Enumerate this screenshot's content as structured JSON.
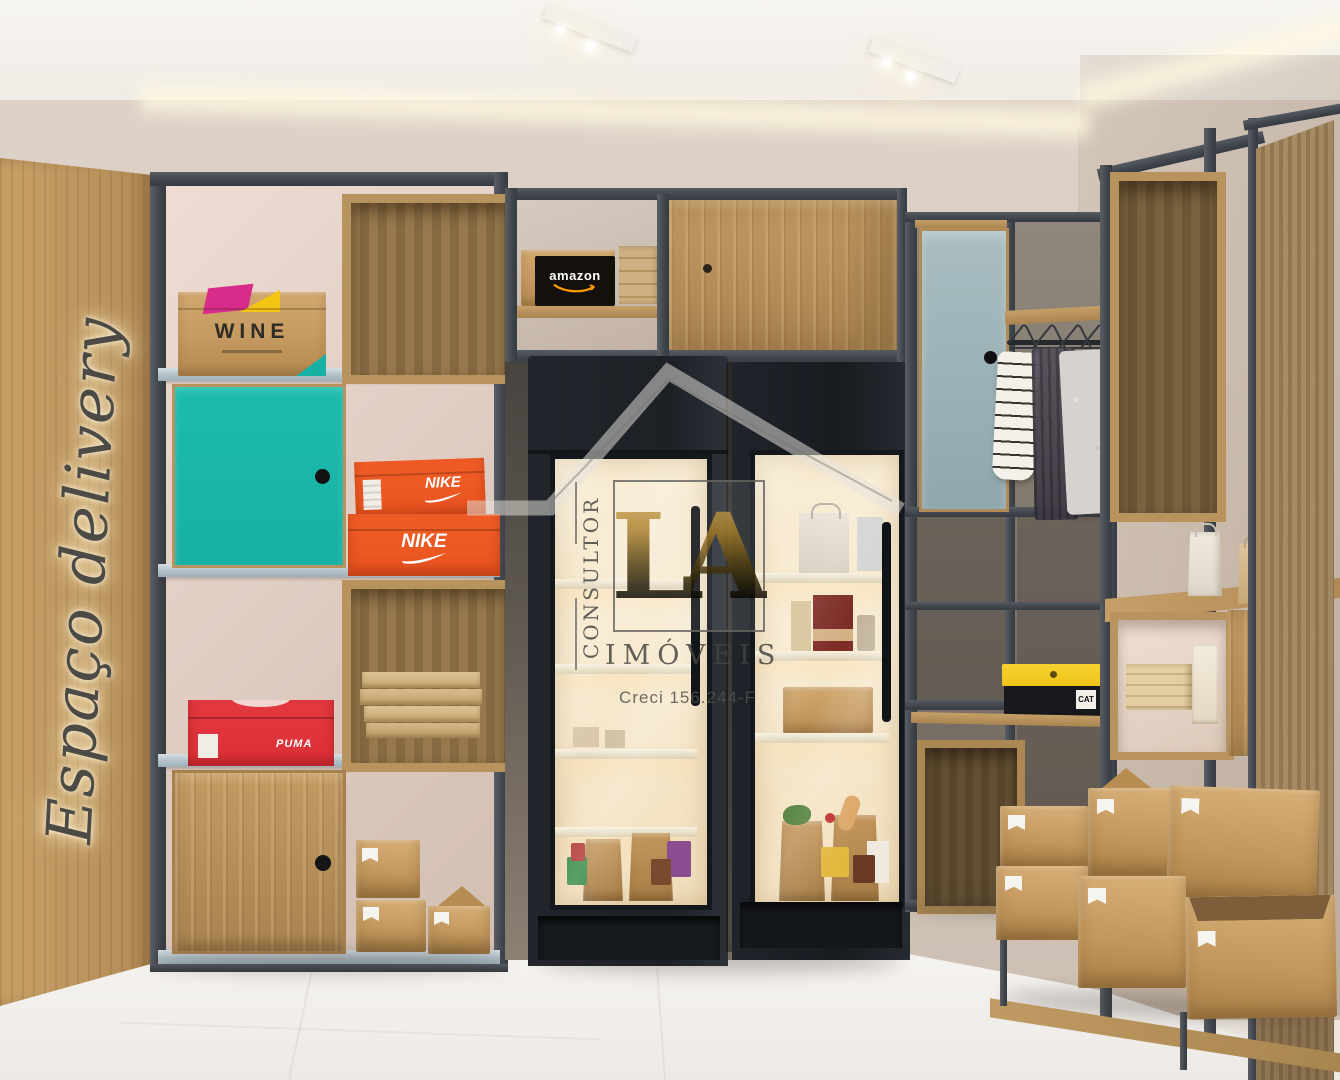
{
  "scene": {
    "wall_sign_text": "Espaço delivery"
  },
  "watermark": {
    "vertical_label": "CONSULTOR",
    "initials": "LA",
    "brand": "IMÓVEIS",
    "license": "Creci 156.244-F"
  },
  "brand_boxes": {
    "wine": "WINE",
    "amazon": "amazon",
    "nike_top": "NIKE",
    "nike_bottom": "NIKE",
    "puma": "PUMA",
    "cat": "CAT"
  },
  "colors": {
    "teal_door": "#17b1a4",
    "nike_orange": "#ea5420",
    "puma_red": "#dd3038",
    "cat_yellow": "#f0c418",
    "metal_frame": "#4a4f56",
    "shelf_board": "#bcc9d2",
    "wood": "#c09a62",
    "fridge_body": "#22262c",
    "fridge_glow": "#f7ead0",
    "wall_beige": "#d6c9bd"
  }
}
